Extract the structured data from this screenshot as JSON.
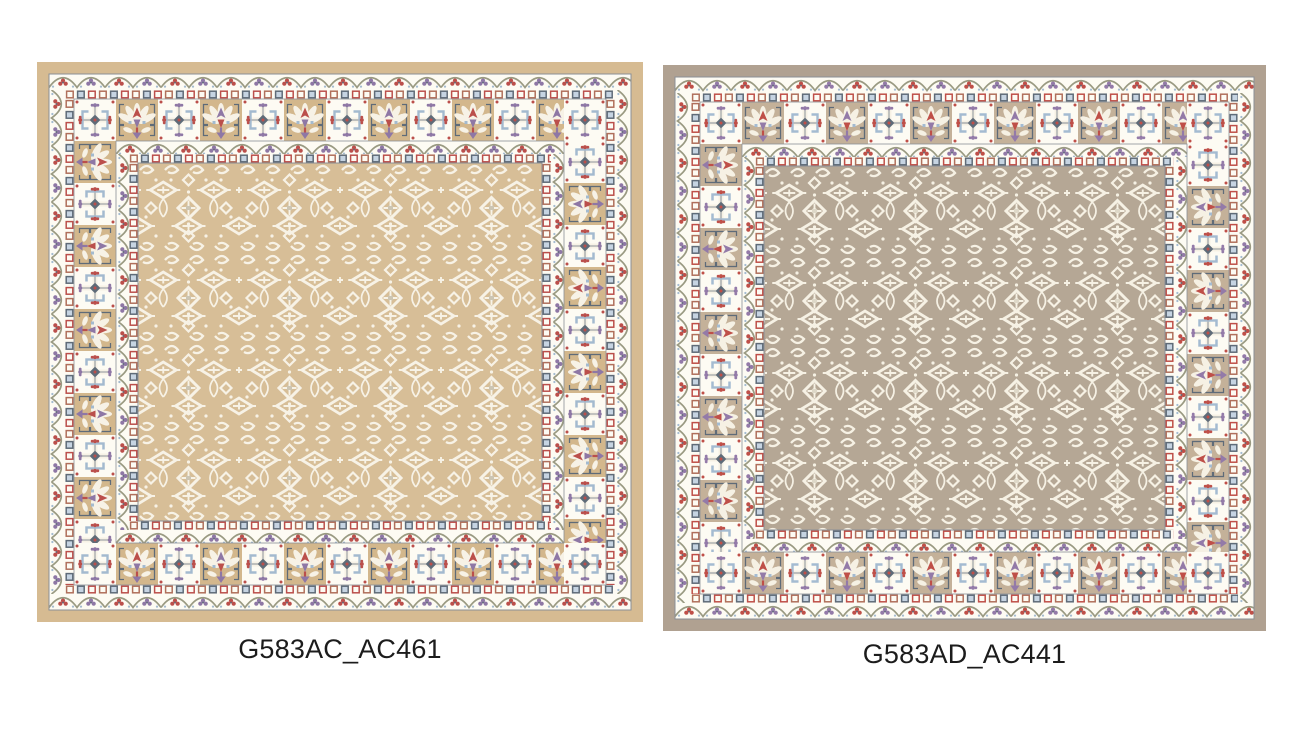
{
  "page": {
    "background": "#ffffff"
  },
  "caption_color": "#1c1c1c",
  "products": [
    {
      "caption": "G583AC_AC461",
      "colors": {
        "frame": "#d6bb92",
        "field": "#d7be97",
        "panel": "#d3b78c",
        "cream": "#f7f2e6",
        "band": "#fdfbf3",
        "red": "#bb4f4b",
        "terracotta": "#b06f5b",
        "blue": "#a3bacf",
        "lightblue": "#c6d4e2",
        "slate": "#5f6b78",
        "purple": "#8e77a5",
        "vine": "#9a9a82",
        "outline": "#8a8f96",
        "accent": "#ccc5b3"
      }
    },
    {
      "caption": "G583AD_AC441",
      "colors": {
        "frame": "#b0a191",
        "field": "#b5a795",
        "panel": "#c4b199",
        "cream": "#f6f1e4",
        "band": "#fdfbf3",
        "red": "#bf4f48",
        "terracotta": "#b06f5b",
        "blue": "#a4bbd1",
        "lightblue": "#c6d4e2",
        "slate": "#5f6b78",
        "purple": "#937aa8",
        "vine": "#9a9a82",
        "outline": "#8a8f96",
        "accent": "#ded8c8"
      }
    }
  ]
}
